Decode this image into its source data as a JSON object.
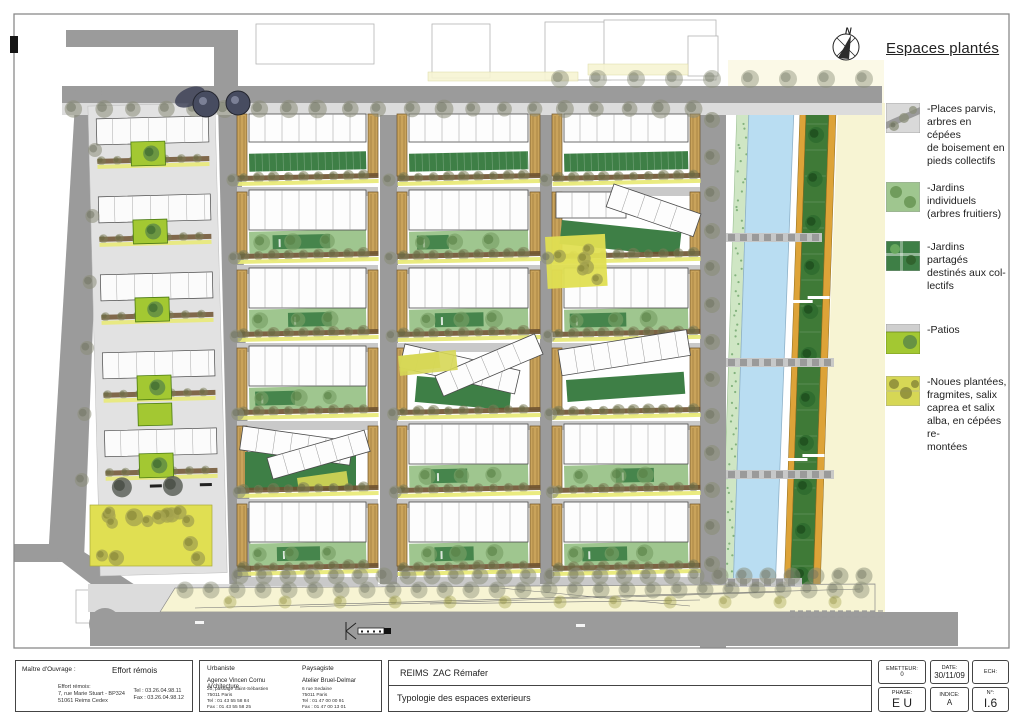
{
  "sheet": {
    "compass_label": "N"
  },
  "legend": {
    "title": "Espaces plantés",
    "items": [
      {
        "name": "places-parvis",
        "label": "-Places parvis,\narbres en cépées\nde boisement en\npieds collectifs"
      },
      {
        "name": "jardins-individuels",
        "label": "-Jardins individuels\n(arbres fruitiers)"
      },
      {
        "name": "jardins-partages",
        "label": "-Jardins partagés\ndestinés aux col-\nlectifs"
      },
      {
        "name": "patios",
        "label": "-Patios"
      },
      {
        "name": "noues-plantees",
        "label": "-Noues plantées,\nfragmites, salix\ncaprea et salix\nalba, en cépées re-\nmontées"
      }
    ]
  },
  "titleblock": {
    "owner": {
      "label": "Maître d'Ouvrage :",
      "value": "Effort rémois",
      "fine": "Effort rémois:\n7, rue Marie Stuart - BP324\n51061 Reims Cedex",
      "contact": "Tel : 03.26.04.98.11\nFax : 03.26.04.98.12"
    },
    "urbaniste": {
      "heading": "Urbaniste",
      "name": "Agence Vincen Cornu Architecture",
      "fine": "20, passage Saint-Sébastien\n75011 Paris\nTel : 01 43 55 58 84\nFax : 01 43 55 58 25"
    },
    "paysagiste": {
      "heading": "Paysagiste",
      "name": "Atelier Bruel-Delmar",
      "fine": "6 rue Sedaine\n75011 Paris\nTel : 01 47 00 00 91\nFax : 01 47 00 13 01"
    },
    "project": {
      "city": "REIMS",
      "name": "ZAC Rémafer",
      "subtitle": "Typologie des espaces exterieurs"
    },
    "meta": {
      "emetteur_label": "EMETTEUR:",
      "emetteur": "0",
      "date_label": "DATE:",
      "date": "30/11/09",
      "ech_label": "ECH:",
      "ech": "",
      "phase_label": "PHASE:",
      "phase": "E U",
      "indice_label": "INDICE:",
      "indice": "A",
      "num_label": "N°:",
      "num": "I.6"
    }
  },
  "colors": {
    "road": "#9b9b9b",
    "road_light": "#c9c9c9",
    "parvis": "#dcdcdc",
    "building_outline": "#4a4a4a",
    "jardins_individuels": "#9fc68f",
    "jardins_partages": "#3e7f46",
    "patios": "#a3c832",
    "noues": "#d6d755",
    "parc": "#e0df52",
    "water": "#b9ddf2",
    "water_edge": "#cfe6c4",
    "median_green": "#3f7a37",
    "median_orange": "#dda338",
    "esplanade": "#f7f4d3",
    "hedge": "#6e5230",
    "endcap": "#c9a35b"
  }
}
